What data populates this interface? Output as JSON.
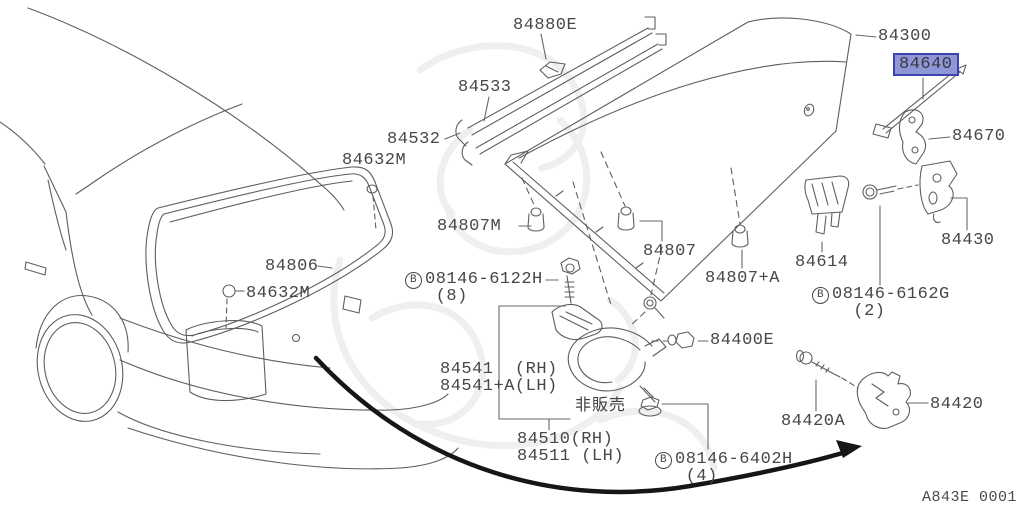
{
  "diagram": {
    "title": "Trunk lid & fitting parts diagram",
    "ref_code": "A843E 0001",
    "highlight_color": "#8e96d8",
    "highlight_border": "#3a43ae",
    "line_color": "#5e5e5e",
    "arrow_color": "#161616",
    "selected_part": "84640"
  },
  "labels": [
    {
      "name": "part-label-84880E",
      "text": "84880E",
      "x": 513,
      "y": 17,
      "interactable": true
    },
    {
      "name": "part-label-84533",
      "text": "84533",
      "x": 458,
      "y": 79,
      "interactable": true
    },
    {
      "name": "part-label-84532",
      "text": "84532",
      "x": 387,
      "y": 131,
      "interactable": true
    },
    {
      "name": "part-label-84632M-top",
      "text": "84632M",
      "x": 342,
      "y": 152,
      "interactable": true
    },
    {
      "name": "part-label-84300",
      "text": "84300",
      "x": 878,
      "y": 28,
      "interactable": true
    },
    {
      "name": "part-label-84640",
      "text": "84640",
      "x": 893,
      "y": 53,
      "interactable": true,
      "highlighted": true
    },
    {
      "name": "part-label-84670",
      "text": "84670",
      "x": 952,
      "y": 128,
      "interactable": true
    },
    {
      "name": "part-label-84430",
      "text": "84430",
      "x": 941,
      "y": 232,
      "interactable": true
    },
    {
      "name": "part-label-84614",
      "text": "84614",
      "x": 795,
      "y": 254,
      "interactable": true
    },
    {
      "name": "part-label-08146-6162G",
      "badge": "B",
      "text": "08146-6162G\n  (2)",
      "x": 812,
      "y": 286,
      "interactable": true
    },
    {
      "name": "part-label-84807M",
      "text": "84807M",
      "x": 437,
      "y": 218,
      "interactable": true
    },
    {
      "name": "part-label-84807",
      "text": "84807",
      "x": 643,
      "y": 243,
      "interactable": true
    },
    {
      "name": "part-label-84807A",
      "text": "84807+A",
      "x": 705,
      "y": 270,
      "interactable": true
    },
    {
      "name": "part-label-84806",
      "text": "84806",
      "x": 265,
      "y": 258,
      "interactable": true
    },
    {
      "name": "part-label-84632M-bottom",
      "text": "84632M",
      "x": 246,
      "y": 285,
      "interactable": true
    },
    {
      "name": "part-label-08146-6122H",
      "badge": "B",
      "text": "08146-6122H\n (8)",
      "x": 405,
      "y": 271,
      "interactable": true
    },
    {
      "name": "part-label-84541",
      "text": "84541  (RH)\n84541+A(LH)",
      "x": 440,
      "y": 361,
      "interactable": true
    },
    {
      "name": "note-not-for-sale",
      "text": "非販売",
      "x": 575,
      "y": 396,
      "interactable": false,
      "cjk": true
    },
    {
      "name": "part-label-84510",
      "text": "84510(RH)\n84511 (LH)",
      "x": 517,
      "y": 431,
      "interactable": true
    },
    {
      "name": "part-label-08146-6402H",
      "badge": "B",
      "text": "08146-6402H\n (4)",
      "x": 655,
      "y": 451,
      "interactable": true
    },
    {
      "name": "part-label-84400E",
      "text": "84400E",
      "x": 710,
      "y": 332,
      "interactable": true
    },
    {
      "name": "part-label-84420A",
      "text": "84420A",
      "x": 781,
      "y": 413,
      "interactable": true
    },
    {
      "name": "part-label-84420",
      "text": "84420",
      "x": 930,
      "y": 396,
      "interactable": true
    }
  ]
}
